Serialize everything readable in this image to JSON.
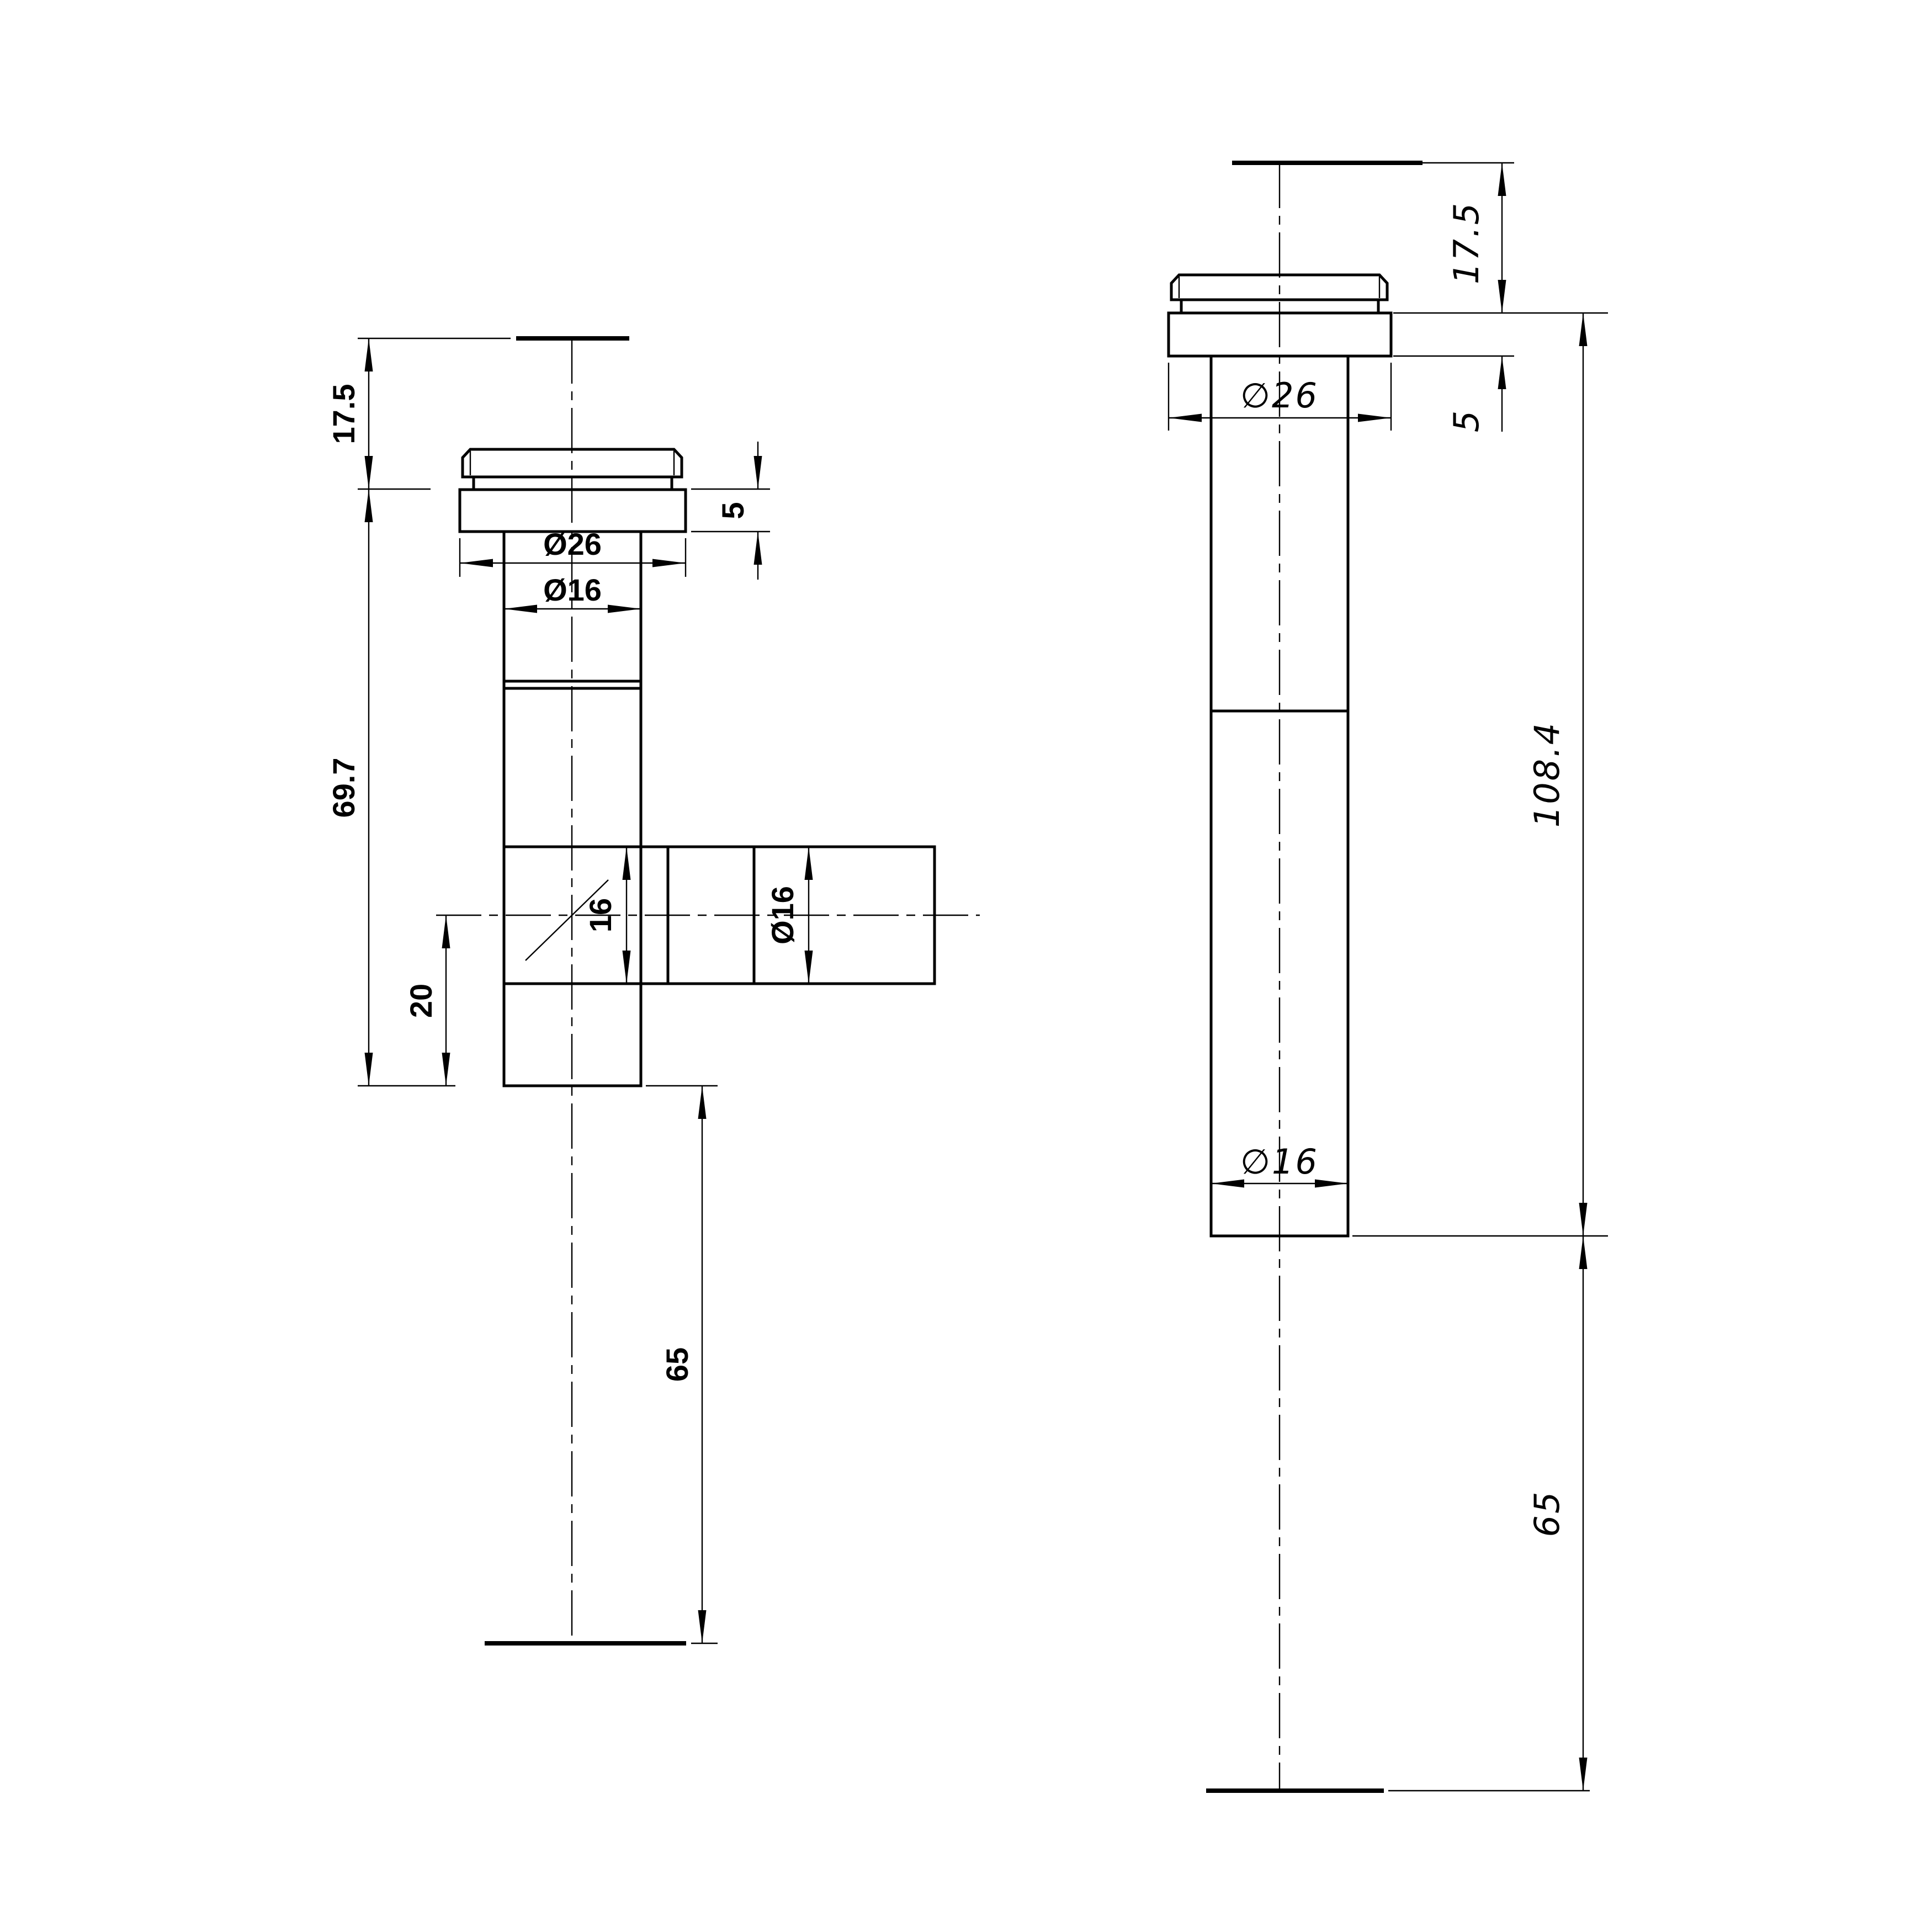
{
  "drawing": {
    "type": "technical_drawing",
    "background": "#ffffff",
    "line_color": "#000000",
    "left_view": {
      "name": "side view with tee branch",
      "dims": {
        "cap_height": "17.5",
        "flange_thickness": "5",
        "flange_diameter": "Ø26",
        "tube_diameter": "Ø16",
        "body_length": "69.7",
        "branch_bore_height": "16",
        "branch_diameter": "Ø16",
        "branch_offset": "20",
        "tail_extension": "65"
      }
    },
    "right_view": {
      "name": "straight view extended",
      "dims": {
        "cap_height": "17.5",
        "flange_thickness": "5",
        "flange_diameter": "∅26",
        "overall_length": "108.4",
        "tube_diameter": "∅16",
        "tail_extension": "65"
      }
    }
  }
}
